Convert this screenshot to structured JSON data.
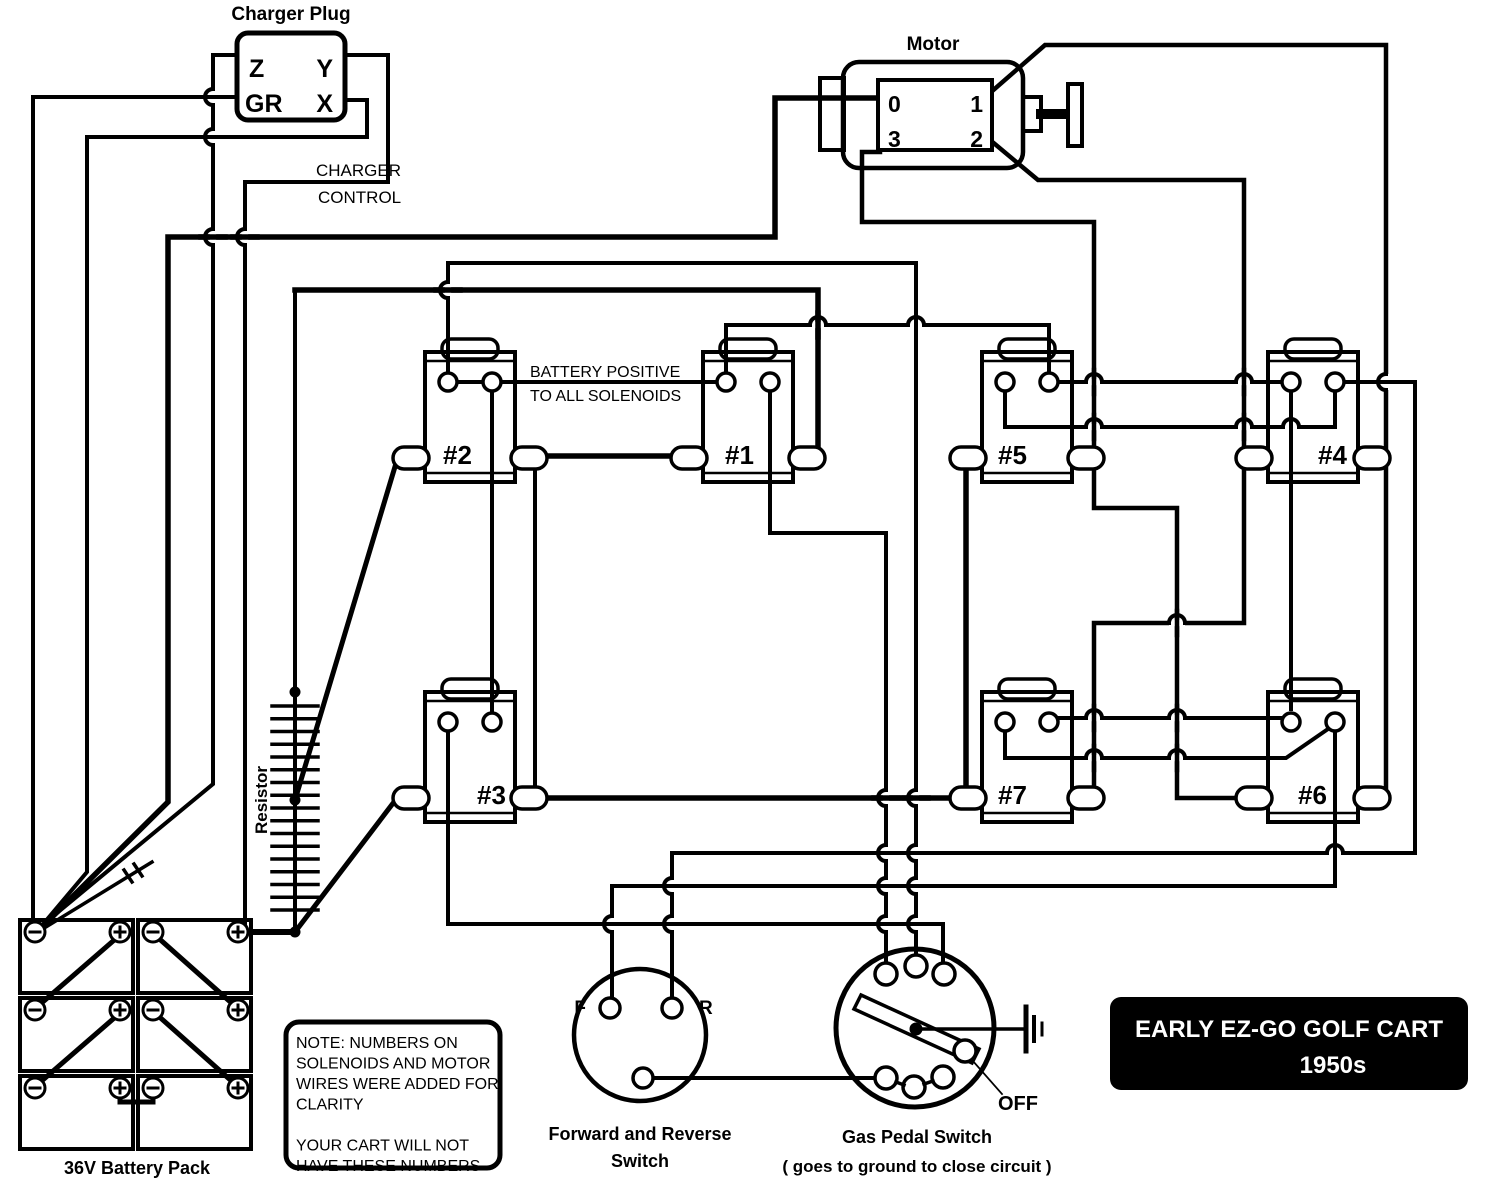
{
  "diagram_title": {
    "line1": "EARLY EZ-GO GOLF CART",
    "line2": "1950s"
  },
  "charger_plug": {
    "title": "Charger Plug",
    "pins": [
      "Z",
      "Y",
      "GR",
      "X"
    ],
    "control_line1": "CHARGER",
    "control_line2": "CONTROL"
  },
  "motor": {
    "title": "Motor",
    "pins": [
      "0",
      "1",
      "3",
      "2"
    ]
  },
  "solenoids": {
    "bus_note_line1": "BATTERY POSITIVE",
    "bus_note_line2": "TO ALL SOLENOIDS",
    "items": [
      {
        "label": "#2"
      },
      {
        "label": "#1"
      },
      {
        "label": "#5"
      },
      {
        "label": "#4"
      },
      {
        "label": "#3"
      },
      {
        "label": "#7"
      },
      {
        "label": "#6"
      }
    ]
  },
  "resistor": {
    "label": "Resistor"
  },
  "battery_pack": {
    "label": "36V Battery Pack",
    "cell_count": "6",
    "positive_symbol": "+",
    "negative_symbol": "-"
  },
  "forward_reverse_switch": {
    "forward_label": "F",
    "reverse_label": "R",
    "caption_line1": "Forward and Reverse",
    "caption_line2": "Switch"
  },
  "gas_pedal_switch": {
    "off_label": "OFF",
    "caption_line1": "Gas Pedal Switch",
    "caption_line2": "( goes to ground to close circuit )"
  },
  "note_box": {
    "lines": [
      "NOTE: NUMBERS ON",
      "SOLENOIDS AND MOTOR",
      "WIRES WERE ADDED FOR",
      "CLARITY",
      "",
      "YOUR CART WILL NOT",
      "HAVE THESE NUMBERS"
    ]
  },
  "colors": {
    "ink": "#000000",
    "paper": "#ffffff",
    "plate_bg": "#000000",
    "plate_text": "#ffffff"
  }
}
